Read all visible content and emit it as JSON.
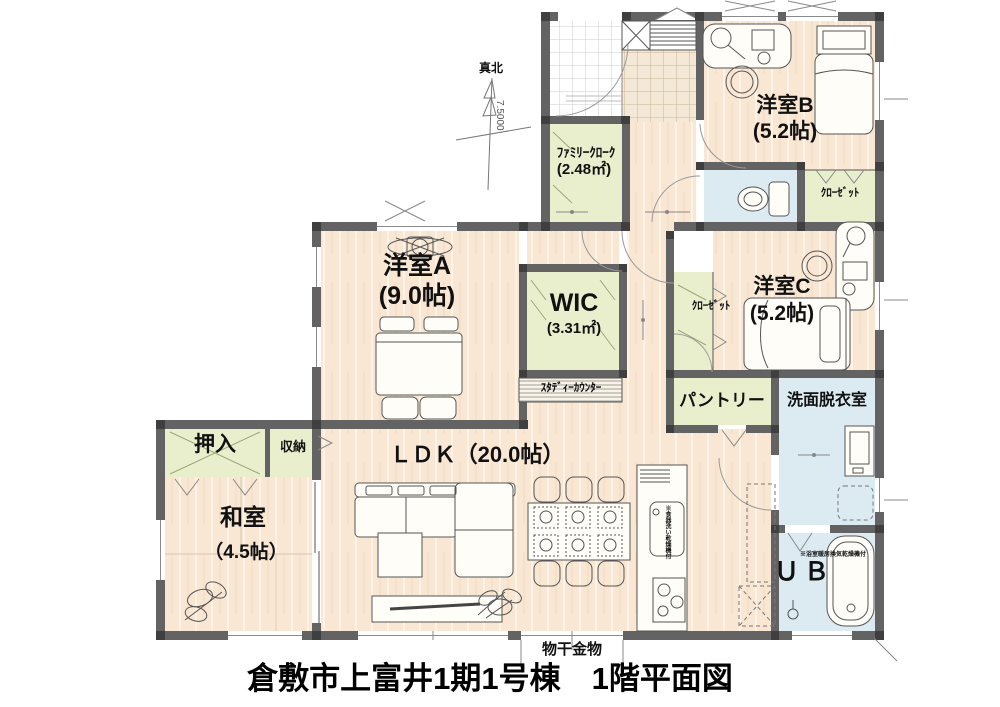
{
  "page": {
    "title": "倉敷市上富井1期1号棟　1階平面図"
  },
  "compass": {
    "label": "真北",
    "dimension": "7.5000"
  },
  "rooms": {
    "yoshitsu_b": {
      "name": "洋室B",
      "size": "(5.2帖)"
    },
    "family_cloak": {
      "name": "ﾌｧﾐﾘｰｸﾛｰｸ",
      "size": "(2.48㎡)"
    },
    "closet_b": {
      "name": "ｸﾛｰｾﾞｯﾄ"
    },
    "yoshitsu_a": {
      "name": "洋室A",
      "size": "(9.0帖)"
    },
    "wic": {
      "name": "WIC",
      "size": "(3.31㎡)"
    },
    "closet_c": {
      "name": "ｸﾛｰｾﾞｯﾄ"
    },
    "yoshitsu_c": {
      "name": "洋室C",
      "size": "(5.2帖)"
    },
    "study_counter": {
      "name": "ｽﾀﾃﾞｨｰｶｳﾝﾀｰ"
    },
    "pantry": {
      "name": "パントリー"
    },
    "laundry_room": {
      "name": "洗面脱衣室"
    },
    "oshiire": {
      "name": "押入"
    },
    "storage": {
      "name": "収納"
    },
    "ldk": {
      "name": "ＬＤＫ（20.0帖）"
    },
    "washitsu": {
      "name": "和室",
      "size": "（4.5帖）"
    },
    "unit_bath": {
      "name": "ＵＢ"
    }
  },
  "notes": {
    "laundry_hardware": "物干金物",
    "bath_dryer": "※浴室暖房換気乾燥機付",
    "dishwasher": "※食器洗い乾燥機付"
  },
  "colors": {
    "wall": "#636363",
    "post": "#3f3f3f",
    "wood_floor": "#f9e7d4",
    "closet_green": "#e9efcd",
    "wet_area_blue": "#dcebf2",
    "tile_beige": "#f4e9d6"
  }
}
